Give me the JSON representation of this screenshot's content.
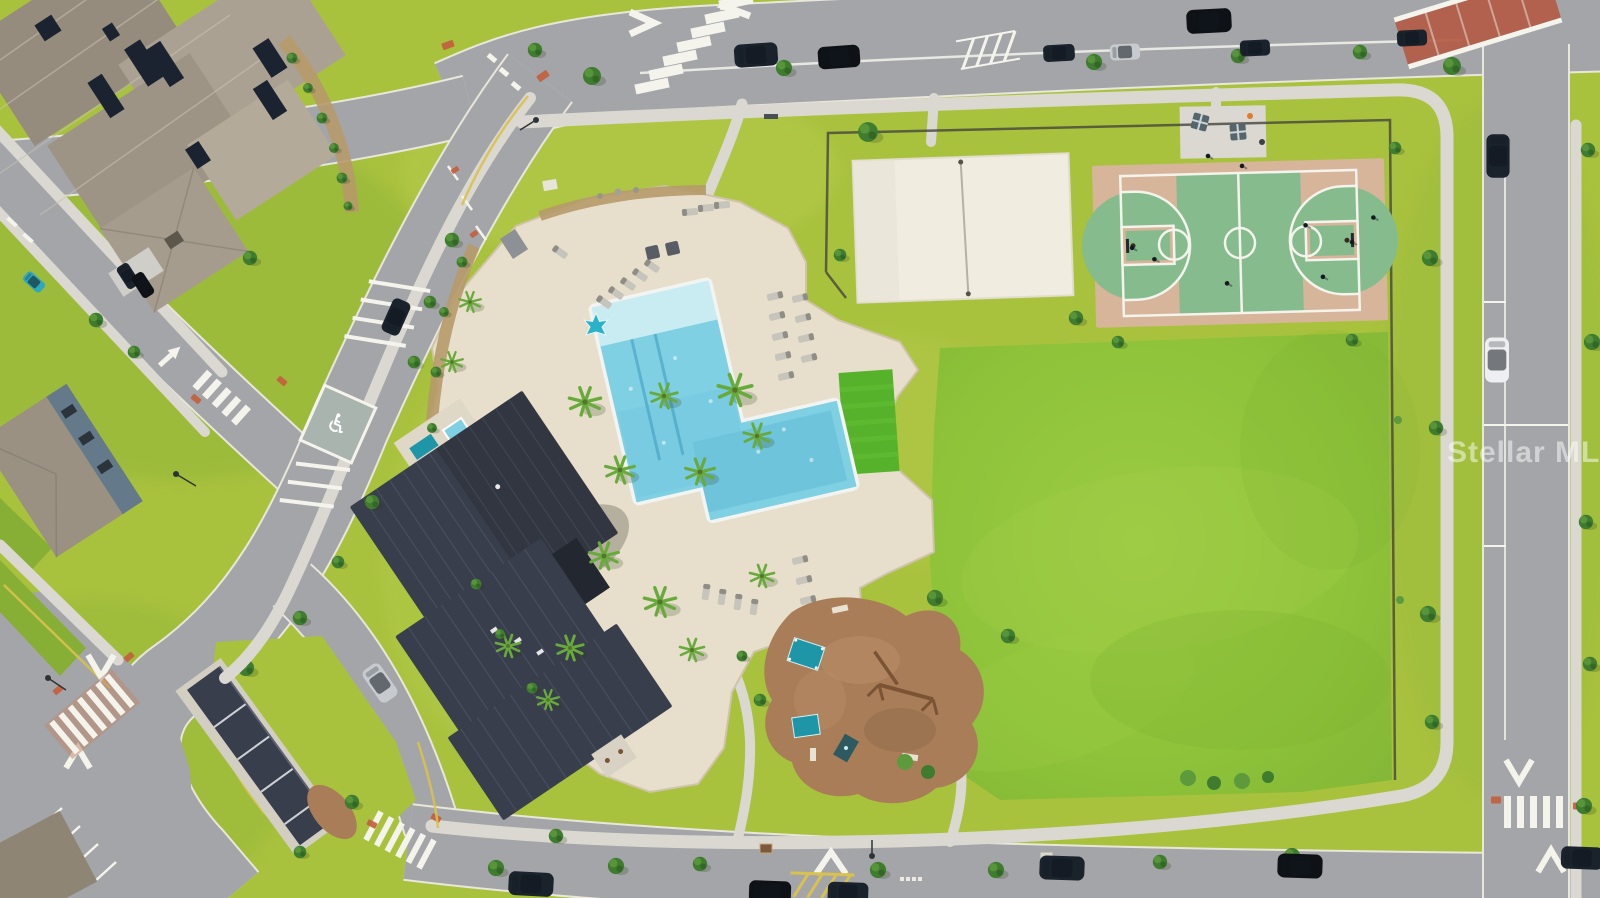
{
  "meta": {
    "type": "aerial-drone-photo",
    "description": "Aerial view of a community amenity center: resort pool and clubhouse with dark metal roofs, pool deck with palms and loungers, artificial turf lawn, sand volleyball court, basketball court, playground with teal shade structures, large event lawn, surrounded by streets with crosswalks, road arrows, parked cars and residential homes with solar panels"
  },
  "watermark": {
    "text": "Stellar MLS",
    "color": "#ffffff",
    "opacity": 0.5
  },
  "palette": {
    "grassBase": "#a9c23e",
    "grassBright": "#94c73c",
    "grassPale": "#bad052",
    "grassDark": "#87af36",
    "asphalt": "#a3a5a8",
    "asphaltEdge": "#e9e6da",
    "concrete": "#dad8d0",
    "paver": "#e7dfcc",
    "paverEdge": "#cfc3a9",
    "roofDark": "#383e4b",
    "roofDarker": "#2c313d",
    "roofRidge": "#4e5567",
    "houseRoof": "#a39a8b",
    "solar": "#1b2330",
    "water": "#7fd0e2",
    "waterDeep": "#54b4d2",
    "ledge": "#c8ecf2",
    "coping": "#f2f4f2",
    "turf": "#55b22a",
    "sand": "#f0ece0",
    "courtGreen": "#85bb8d",
    "courtTan": "#d6b59a",
    "lineWhite": "#f4f3ec",
    "mulch": "#a97d58",
    "wood": "#7a5434",
    "teal": "#1f95a8",
    "tree": "#3f7c2f",
    "treeDark": "#2e5e22",
    "bush": "#5d9a3c",
    "bed": "#b69a6a",
    "redPad": "#c35f3f",
    "redBrick": "#b25a43",
    "yellow": "#d9c14f",
    "carDark": "#1a222c",
    "carBlack": "#0e1216",
    "carSilver": "#c7cbcf",
    "carWhite": "#edeff0",
    "carTeal": "#2fa8ba",
    "shadow": "#2c3a17"
  },
  "scene": {
    "areas": [
      "residential homes with solar panels",
      "curving streets with parked cars",
      "accessible parking stall",
      "community clubhouse",
      "resort pool with tanning ledge",
      "pool deck with palms and loungers",
      "spa cabanas",
      "artificial turf lawn",
      "sand volleyball court",
      "basketball court with players",
      "picnic plaza",
      "playground with shade sails and swings",
      "event lawn",
      "sidewalks, crosswalks and road arrows"
    ]
  }
}
